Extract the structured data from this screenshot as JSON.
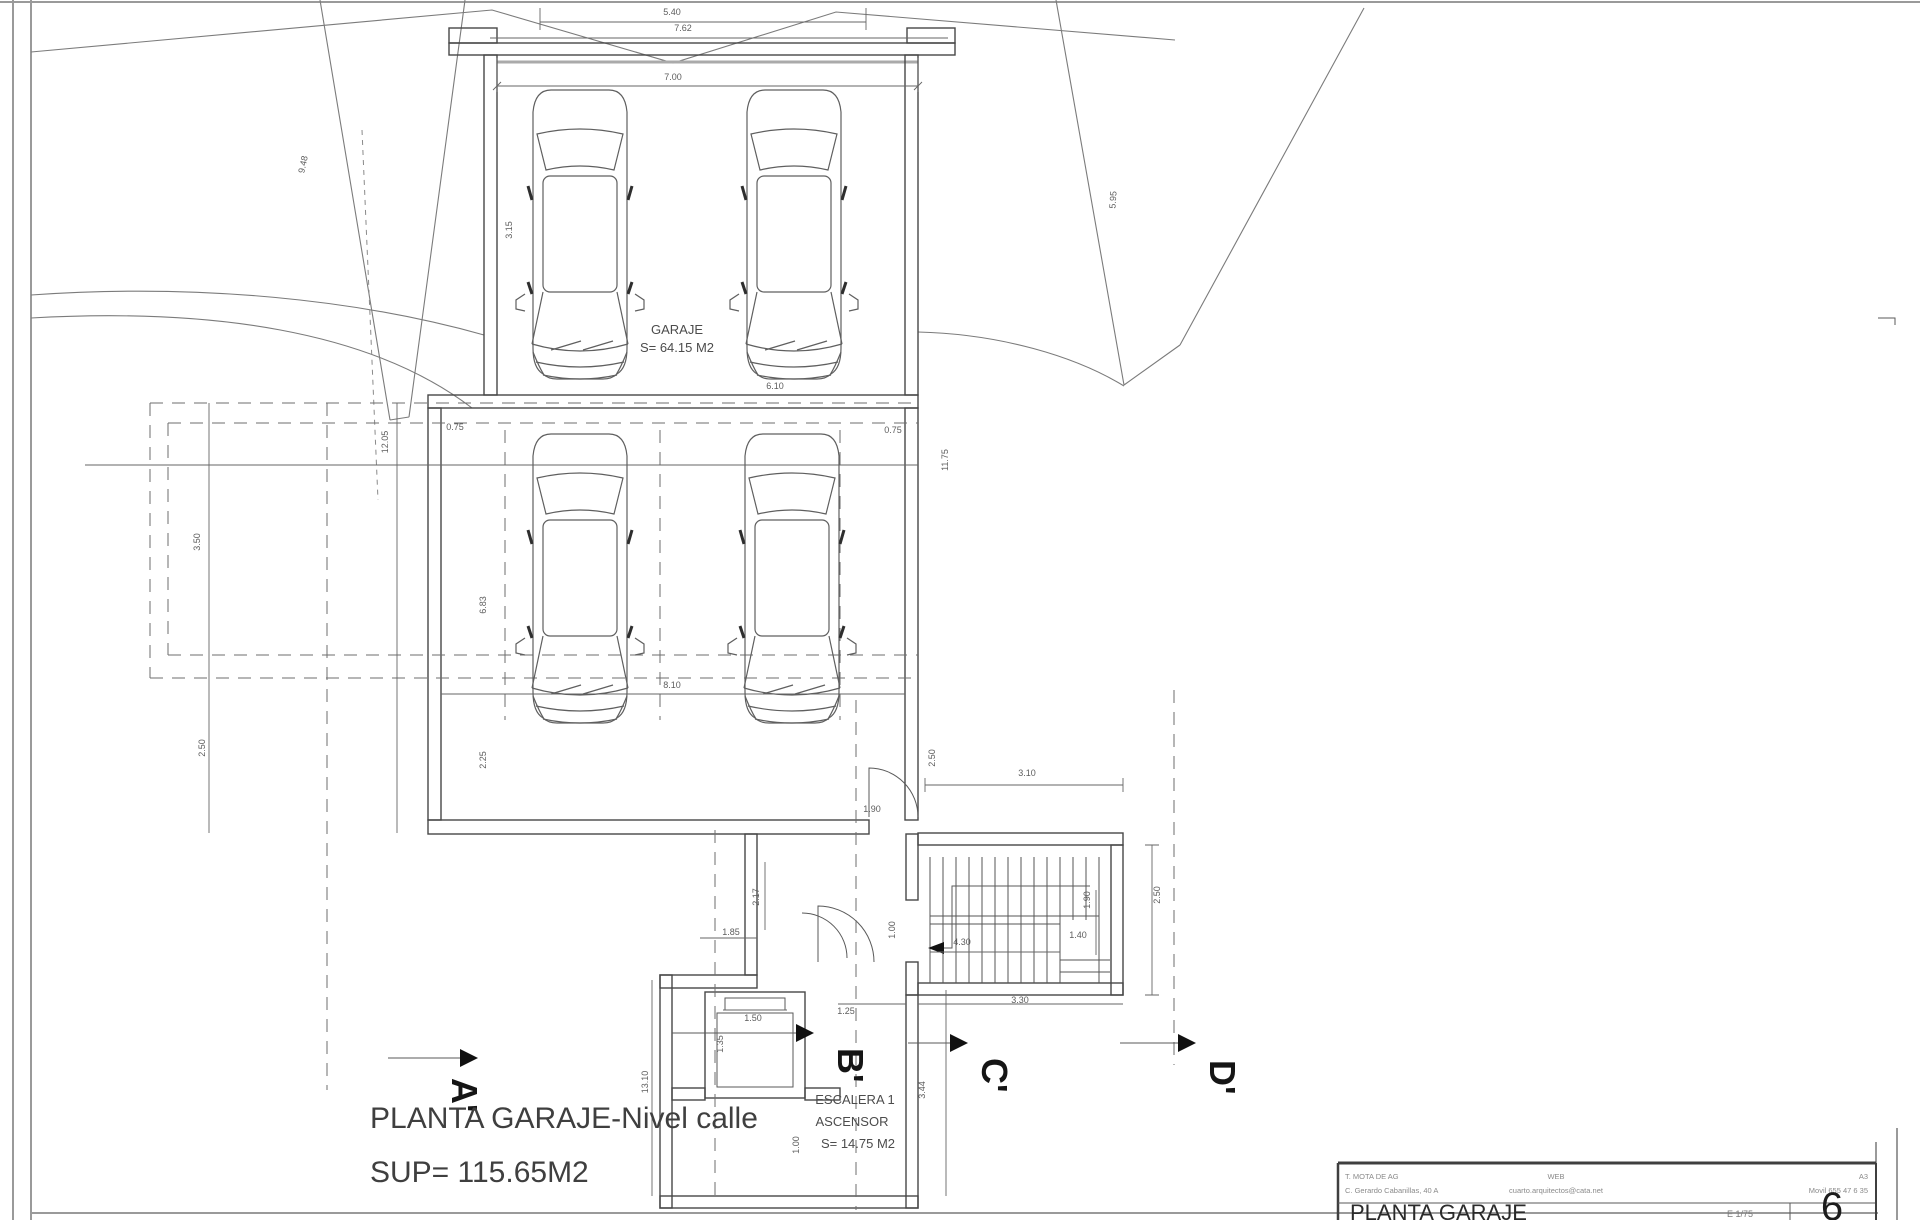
{
  "page": {
    "background": "#ffffff",
    "line_color": "#4a4a4a"
  },
  "plan": {
    "garage_label": {
      "line1": "GARAJE",
      "line2": "S= 64.15 M2"
    },
    "stair_label": {
      "line1": "ESCALERA 1",
      "line2": "ASCENSOR",
      "line3": "S= 14.75 M2"
    },
    "caption": {
      "line1": "PLANTA GARAJE-Nivel calle",
      "line2": "SUP= 115.65M2"
    },
    "section_markers": [
      {
        "label": "A'"
      },
      {
        "label": "B'"
      },
      {
        "label": "C'"
      },
      {
        "label": "D'"
      }
    ]
  },
  "dimensions": [
    {
      "t": "5.40",
      "x": 672,
      "y": 15,
      "r": 0
    },
    {
      "t": "7.62",
      "x": 683,
      "y": 31,
      "r": 0
    },
    {
      "t": "7.00",
      "x": 673,
      "y": 80,
      "r": 0
    },
    {
      "t": "9.48",
      "x": 306,
      "y": 165,
      "r": -78
    },
    {
      "t": "5.95",
      "x": 1116,
      "y": 200,
      "r": -86
    },
    {
      "t": "3.15",
      "x": 512,
      "y": 230,
      "r": -90
    },
    {
      "t": "6.10",
      "x": 775,
      "y": 389,
      "r": 0
    },
    {
      "t": "12.05",
      "x": 388,
      "y": 442,
      "r": -90
    },
    {
      "t": "0.75",
      "x": 455,
      "y": 430,
      "r": 0
    },
    {
      "t": "0.75",
      "x": 893,
      "y": 433,
      "r": 0
    },
    {
      "t": "11.75",
      "x": 948,
      "y": 460,
      "r": -90
    },
    {
      "t": "3.50",
      "x": 200,
      "y": 542,
      "r": -90
    },
    {
      "t": "6.83",
      "x": 486,
      "y": 605,
      "r": -90
    },
    {
      "t": "2.50",
      "x": 205,
      "y": 748,
      "r": -90
    },
    {
      "t": "2.25",
      "x": 486,
      "y": 760,
      "r": -90
    },
    {
      "t": "8.10",
      "x": 672,
      "y": 688,
      "r": 0
    },
    {
      "t": "2.50",
      "x": 935,
      "y": 758,
      "r": -90
    },
    {
      "t": "3.10",
      "x": 1027,
      "y": 776,
      "r": 0
    },
    {
      "t": "1.90",
      "x": 872,
      "y": 812,
      "r": 0
    },
    {
      "t": "2.50",
      "x": 1160,
      "y": 895,
      "r": -90
    },
    {
      "t": "1.00",
      "x": 895,
      "y": 930,
      "r": -90
    },
    {
      "t": "1.90",
      "x": 1090,
      "y": 900,
      "r": -90
    },
    {
      "t": "1.40",
      "x": 1078,
      "y": 938,
      "r": 0
    },
    {
      "t": "4.30",
      "x": 962,
      "y": 945,
      "r": 0
    },
    {
      "t": "3.30",
      "x": 1020,
      "y": 1003,
      "r": 0
    },
    {
      "t": "2.17",
      "x": 759,
      "y": 897,
      "r": -90
    },
    {
      "t": "1.85",
      "x": 731,
      "y": 935,
      "r": 0
    },
    {
      "t": "1.25",
      "x": 846,
      "y": 1014,
      "r": 0
    },
    {
      "t": "1.50",
      "x": 753,
      "y": 1021,
      "r": 0
    },
    {
      "t": "1.35",
      "x": 723,
      "y": 1044,
      "r": -90
    },
    {
      "t": "13.10",
      "x": 648,
      "y": 1082,
      "r": -90
    },
    {
      "t": "1.00",
      "x": 799,
      "y": 1145,
      "r": -90
    },
    {
      "t": "3.44",
      "x": 925,
      "y": 1090,
      "r": -90
    }
  ],
  "title_block": {
    "office_line1": "T. MOTA DE AG",
    "office_line2": "C. Gerardo Cabanillas, 40 A",
    "center_line1": "WEB",
    "center_line2": "cuarto.arquitectos@cata.net",
    "right_line1": "A3",
    "right_line2": "Movil 655 47 6 35",
    "sheet_title": "PLANTA GARAJE",
    "scale": "E 1/75",
    "sheet_number": "6"
  }
}
